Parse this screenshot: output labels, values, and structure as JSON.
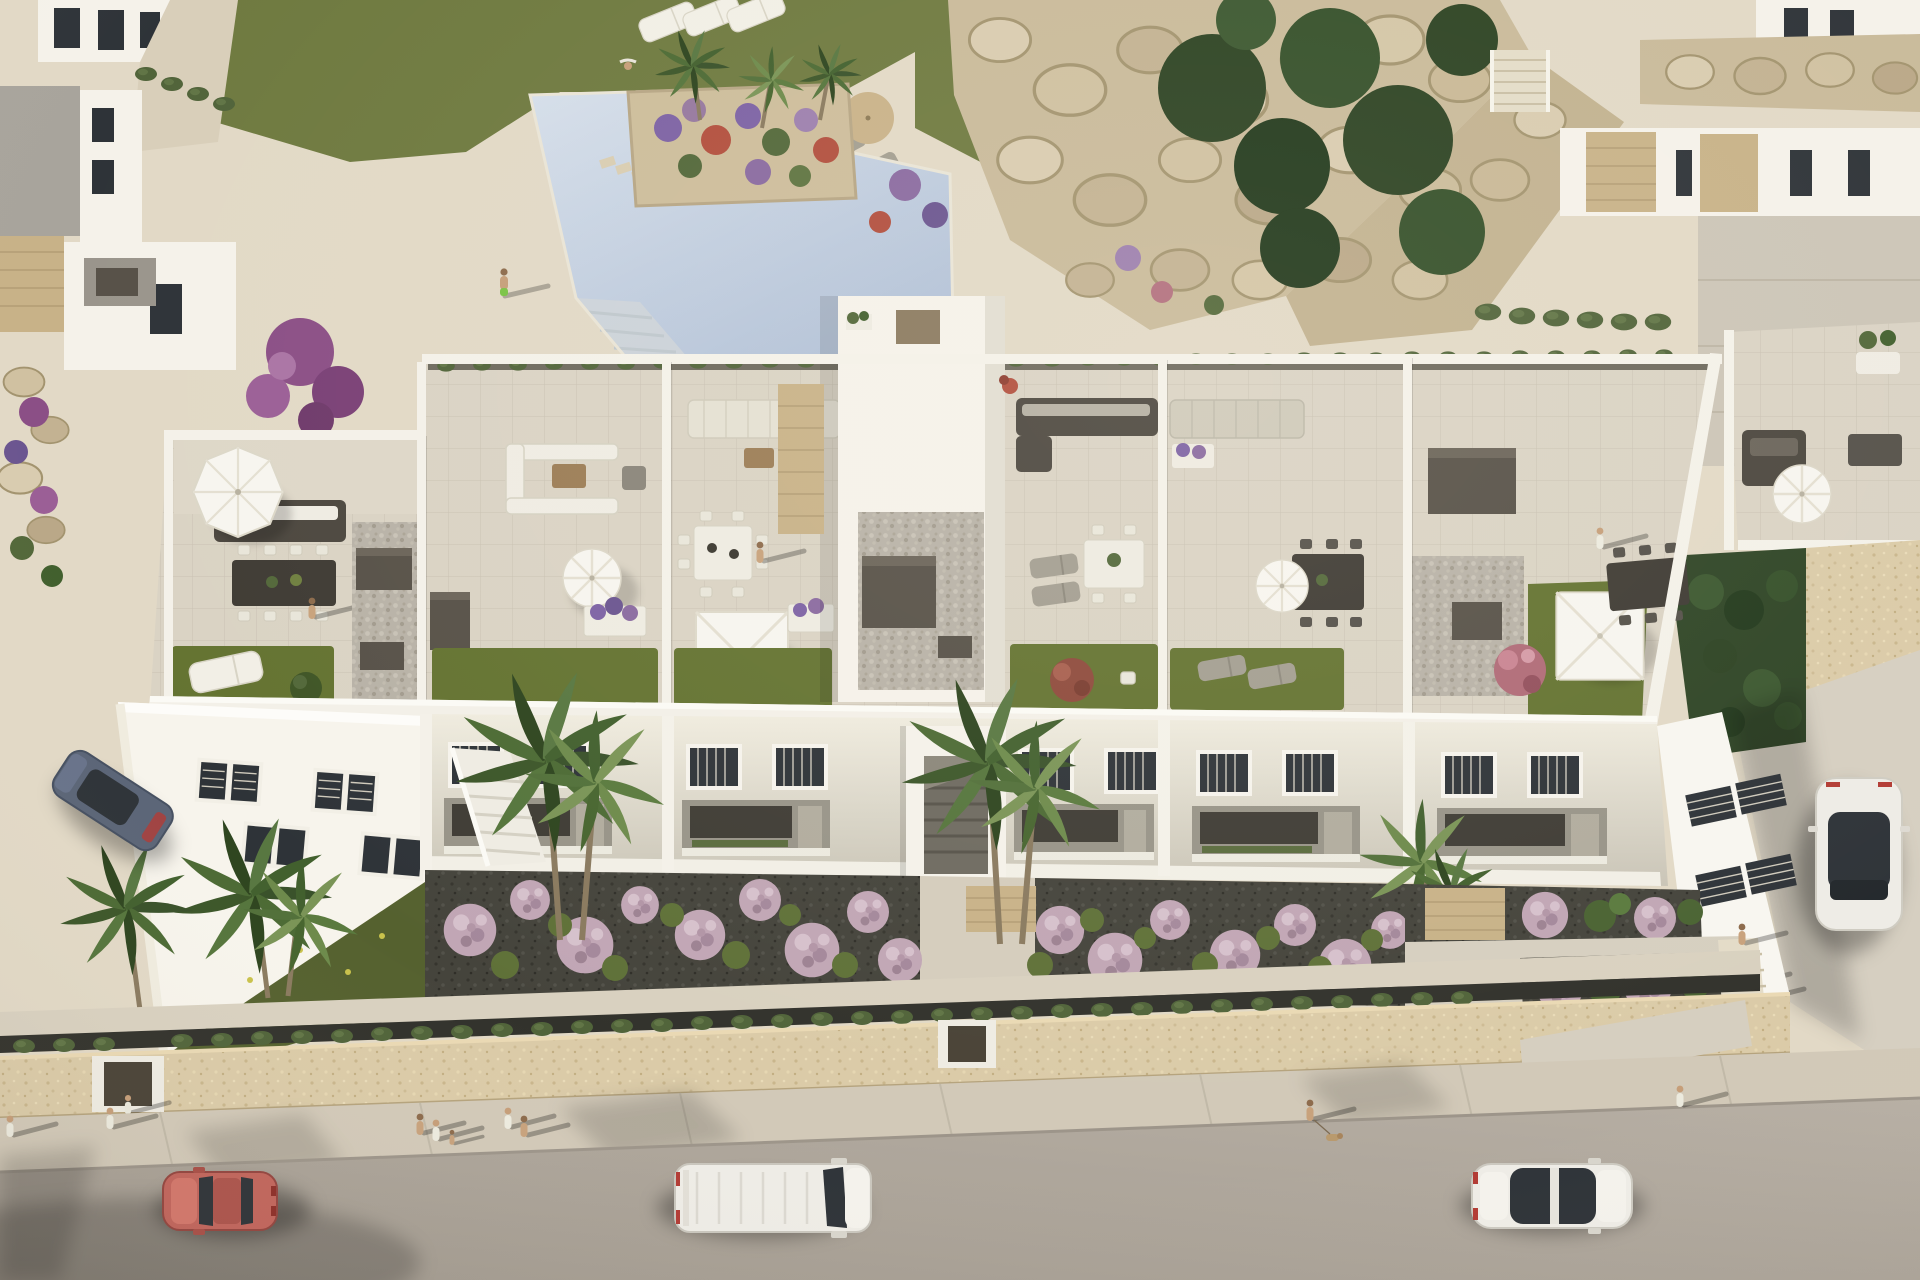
{
  "meta": {
    "type": "3d-architectural-aerial-render",
    "description": "Bird's-eye rendering of a white Mediterranean apartment block with six rooftop solarium terraces, communal swimming pool with planted island, boulder rockery gardens, front gardens with lilac flower balls and palms, boundary stone wall, sidewalk and access road with vehicles and pedestrians",
    "width_px": 1920,
    "height_px": 1280
  },
  "palette": {
    "deck": "#e2d9c6",
    "deck_light": "#eae2cf",
    "pool_light": "#d6dfea",
    "pool_deep": "#b2c1d7",
    "lawn": "#6f7a40",
    "lawn_dark": "#596730",
    "roof_grass": "#647331",
    "rock": "#d4c6a7",
    "rock_dark": "#b9a885",
    "tree_dark": "#2d4323",
    "hedge": "#51643a",
    "wall_white": "#f5f2ea",
    "wall_shade": "#d6d2c6",
    "tile": "#dad3c4",
    "gravel": "#b8b2a7",
    "box_dark": "#575148",
    "furn_dark": "#4c473f",
    "furn_white": "#efece3",
    "stone_tan": "#c8b288",
    "window_dark": "#3a372f",
    "garden_soil": "#44433b",
    "bush_lilac": "#c1a6b5",
    "grass_tuft": "#5f7138",
    "sand_wall": "#dbcba8",
    "sidewalk": "#d2c9b8",
    "road": "#b4aca1",
    "car_red": "#c2655c",
    "car_white": "#eeece6",
    "car_blue": "#5b6577",
    "glass": "#2e3338",
    "parasol_white": "#f7f5ef",
    "umbrella_tan": "#c9b289",
    "flower_purple": "#7d62a4",
    "flower_red": "#b24f3e",
    "flower_pink": "#b06a77"
  },
  "scene": {
    "community": {
      "label": "communal pool deck with landscaped gardens, boulder rockery and neighbouring villas",
      "elements": [
        "swimming-pool",
        "pool-island-planter",
        "stepping-stones",
        "boulder-rockery",
        "lawn-with-loungers",
        "beach-umbrella",
        "neighbor-villas",
        "dark-green-trees",
        "driveway"
      ]
    },
    "building": {
      "label": "three-storey white apartment block with six rooftop solarium terraces",
      "terrace_count": 6,
      "terrace_features": [
        "artificial-grass",
        "white-canopy-pergola",
        "round-parasol",
        "octagonal-parasol",
        "outdoor-sofa",
        "dining-set",
        "sun-loungers",
        "gravel-roof",
        "ac-units",
        "planters"
      ],
      "facade_features": [
        "louvered-window-pairs",
        "recessed-balconies",
        "stair-towers",
        "entrance-walkway",
        "entrance-plaza",
        "side-skylight-windows"
      ]
    },
    "street": {
      "label": "access road with sandstone boundary wall, hedge and sidewalk",
      "vehicles": [
        {
          "name": "red-coupe",
          "color": "#c2655c"
        },
        {
          "name": "white-van",
          "color": "#eeece6"
        },
        {
          "name": "white-sedan",
          "color": "#eeece6"
        },
        {
          "name": "white-suv",
          "color": "#eeece6"
        },
        {
          "name": "blue-hatchback",
          "color": "#5b6577"
        }
      ],
      "pedestrian_groups": 8
    }
  }
}
